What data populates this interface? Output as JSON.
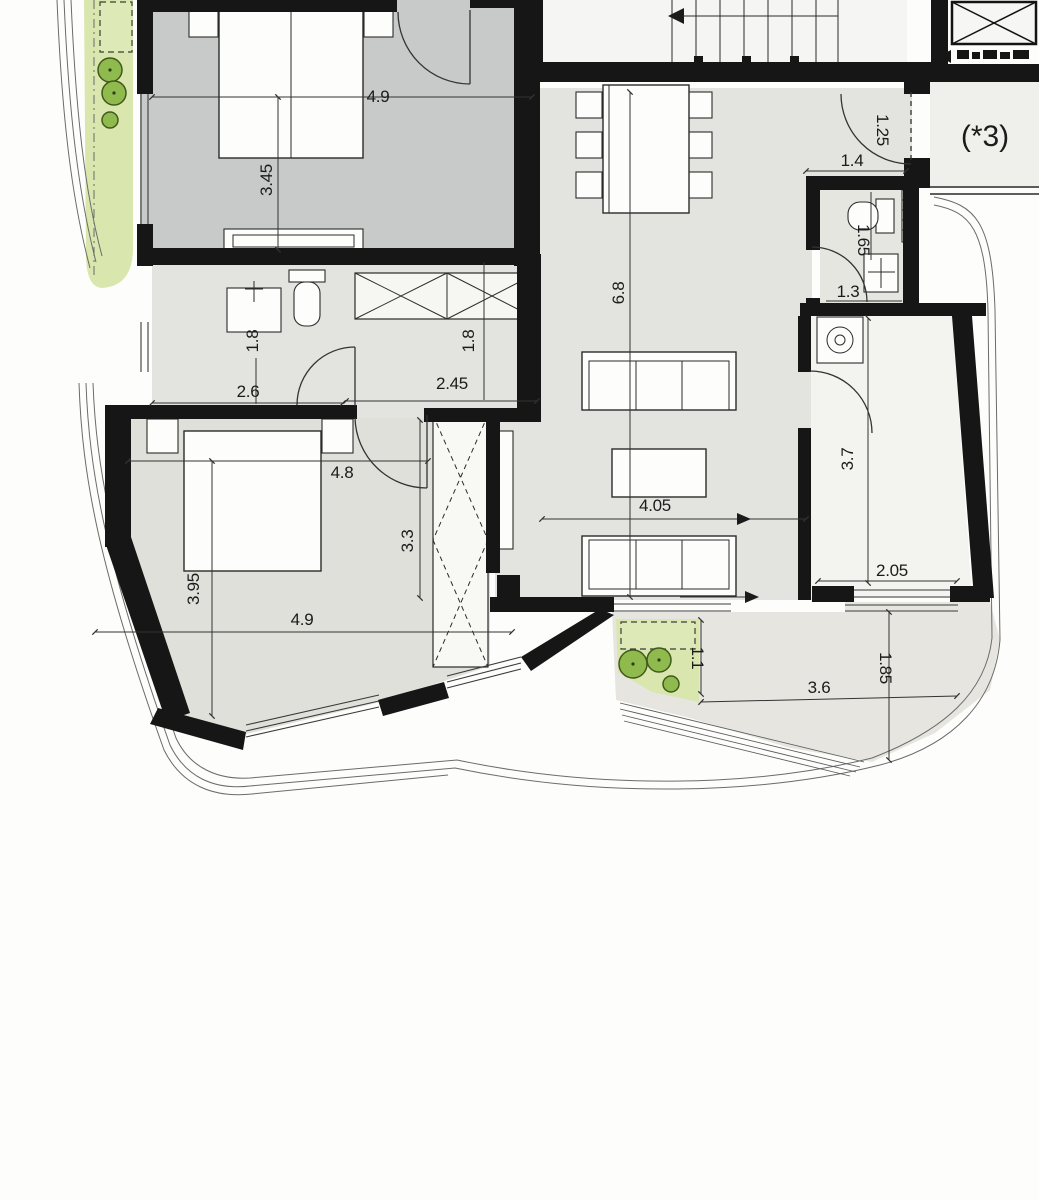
{
  "plan": {
    "unit_note": "(*3)",
    "dims": {
      "bedroom1_width": "4.9",
      "bedroom1_depth": "3.45",
      "living_length": "6.8",
      "entry_door": "1.25",
      "entry_hall": "1.4",
      "wc_depth": "1.65",
      "wc_width": "1.3",
      "bath_niche": "1.8",
      "bath_width": "2.6",
      "hall_length": "2.45",
      "hall_width": "1.8",
      "bedroom2_top": "4.8",
      "bedroom2_right": "3.3",
      "living_width": "4.05",
      "utility_depth": "3.7",
      "bedroom2_left": "3.95",
      "bedroom2_bottom": "4.9",
      "utility_width": "2.05",
      "planter_depth": "1.1",
      "terrace_width": "3.6",
      "terrace_depth": "1.85"
    }
  }
}
